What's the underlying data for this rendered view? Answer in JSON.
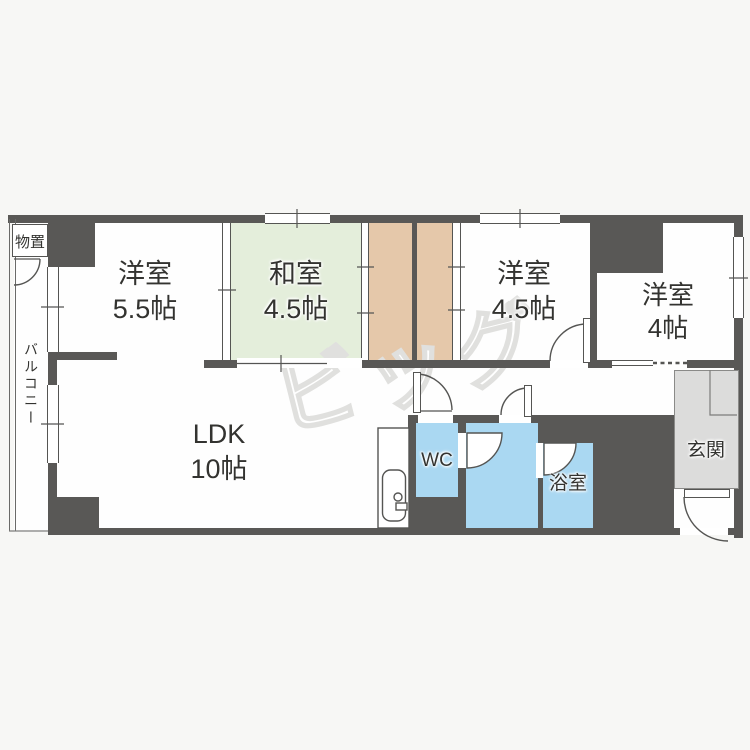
{
  "title": "間取り図",
  "colors": {
    "wall": "#595856",
    "line": "#555553",
    "tatami": "#e4eedb",
    "closet": "#e5c8aa",
    "wet": "#aad8f2",
    "genkan": "#dcdcdb",
    "bg": "#f7f7f5",
    "floor": "#fefefe",
    "label": "#333330",
    "wm": "#e0e0de"
  },
  "rooms": {
    "yoshitsu55": {
      "name": "洋室",
      "size": "5.5帖"
    },
    "washitsu": {
      "name": "和室",
      "size": "4.5帖"
    },
    "yoshitsu45": {
      "name": "洋室",
      "size": "4.5帖"
    },
    "yoshitsu4": {
      "name": "洋室",
      "size": "4帖"
    },
    "ldk": {
      "name": "LDK",
      "size": "10帖"
    },
    "wc": {
      "name": "WC"
    },
    "bath": {
      "name": "浴室"
    },
    "genkan": {
      "name": "玄関"
    },
    "monooki": {
      "name": "物置"
    },
    "balcony": {
      "name": "バルコニー"
    }
  },
  "watermark": {
    "text": "ビッグ"
  }
}
